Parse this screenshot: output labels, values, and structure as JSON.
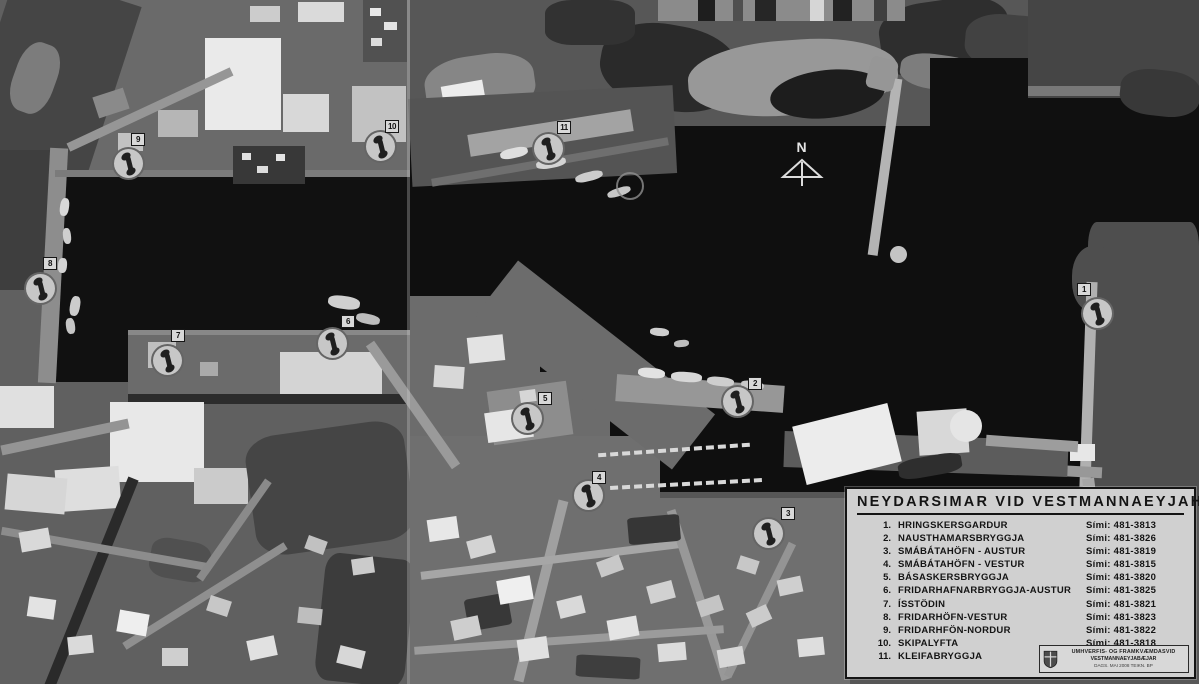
{
  "legend": {
    "title": "NEYDARSIMAR VID VESTMANNAEYJAHÖFN",
    "phone_label": "Sími:",
    "items": [
      {
        "num": "1.",
        "name": "HRINGSKERSGARDUR",
        "phone": "481-3813"
      },
      {
        "num": "2.",
        "name": "NAUSTHAMARSBRYGGJA",
        "phone": "481-3826"
      },
      {
        "num": "3.",
        "name": "SMÁBÁTAHÖFN - AUSTUR",
        "phone": "481-3819"
      },
      {
        "num": "4.",
        "name": "SMÁBÁTAHÖFN - VESTUR",
        "phone": "481-3815"
      },
      {
        "num": "5.",
        "name": "BÁSASKERSBRYGGJA",
        "phone": "481-3820"
      },
      {
        "num": "6.",
        "name": "FRIDARHAFNARBRYGGJA-AUSTUR",
        "phone": "481-3825"
      },
      {
        "num": "7.",
        "name": "ÍSSTÖDIN",
        "phone": "481-3821"
      },
      {
        "num": "8.",
        "name": "FRIDARHÖFN-VESTUR",
        "phone": "481-3823"
      },
      {
        "num": "9.",
        "name": "FRIDARHFÖN-NORDUR",
        "phone": "481-3822"
      },
      {
        "num": "10.",
        "name": "SKIPALYFTA",
        "phone": "481-3818"
      },
      {
        "num": "11.",
        "name": "KLEIFABRYGGJA",
        "phone": "481-3824"
      }
    ]
  },
  "north": {
    "label": "N"
  },
  "stamp": {
    "line1": "UMHVERFIS- OG FRAMKVÆMDASVID",
    "line2": "VESTMANNAEYJABÆJAR",
    "line3": "DAGS. MAI 2008        TEIKN. BP"
  },
  "markers": [
    {
      "num": "1",
      "name": "HRINGSKERSGARDUR",
      "x": 1097,
      "y": 313,
      "bx": 1077,
      "by": 283
    },
    {
      "num": "2",
      "name": "NAUSTHAMARSBRYGGJA",
      "x": 737,
      "y": 401,
      "bx": 748,
      "by": 377
    },
    {
      "num": "3",
      "name": "SMÁBÁTAHÖFN - AUSTUR",
      "x": 768,
      "y": 533,
      "bx": 781,
      "by": 507
    },
    {
      "num": "4",
      "name": "SMÁBÁTAHÖFN - VESTUR",
      "x": 588,
      "y": 495,
      "bx": 592,
      "by": 471
    },
    {
      "num": "5",
      "name": "BÁSASKERSBRYGGJA",
      "x": 527,
      "y": 418,
      "bx": 538,
      "by": 392
    },
    {
      "num": "6",
      "name": "FRIDARHAFNARBRYGGJA-AUSTUR",
      "x": 332,
      "y": 343,
      "bx": 341,
      "by": 315
    },
    {
      "num": "7",
      "name": "ÍSSTÖDIN",
      "x": 167,
      "y": 360,
      "bx": 171,
      "by": 329
    },
    {
      "num": "8",
      "name": "FRIDARHÖFN-VESTUR",
      "x": 40,
      "y": 288,
      "bx": 43,
      "by": 257
    },
    {
      "num": "9",
      "name": "FRIDARHFÖN-NORDUR",
      "x": 128,
      "y": 163,
      "bx": 131,
      "by": 133
    },
    {
      "num": "10",
      "name": "SKIPALYFTA",
      "x": 380,
      "y": 146,
      "bx": 385,
      "by": 120
    },
    {
      "num": "11",
      "name": "KLEIFABRYGGJA",
      "x": 548,
      "y": 148,
      "bx": 557,
      "by": 121
    }
  ],
  "ring_marker": {
    "x": 628,
    "y": 184
  },
  "colors": {
    "water": "#0f0f0f",
    "land": "#5a5a5a",
    "legend_bg": "#d0d0d0",
    "marker_bg": "#c7c7c7",
    "marker_glyph": "#1f1f1f"
  }
}
